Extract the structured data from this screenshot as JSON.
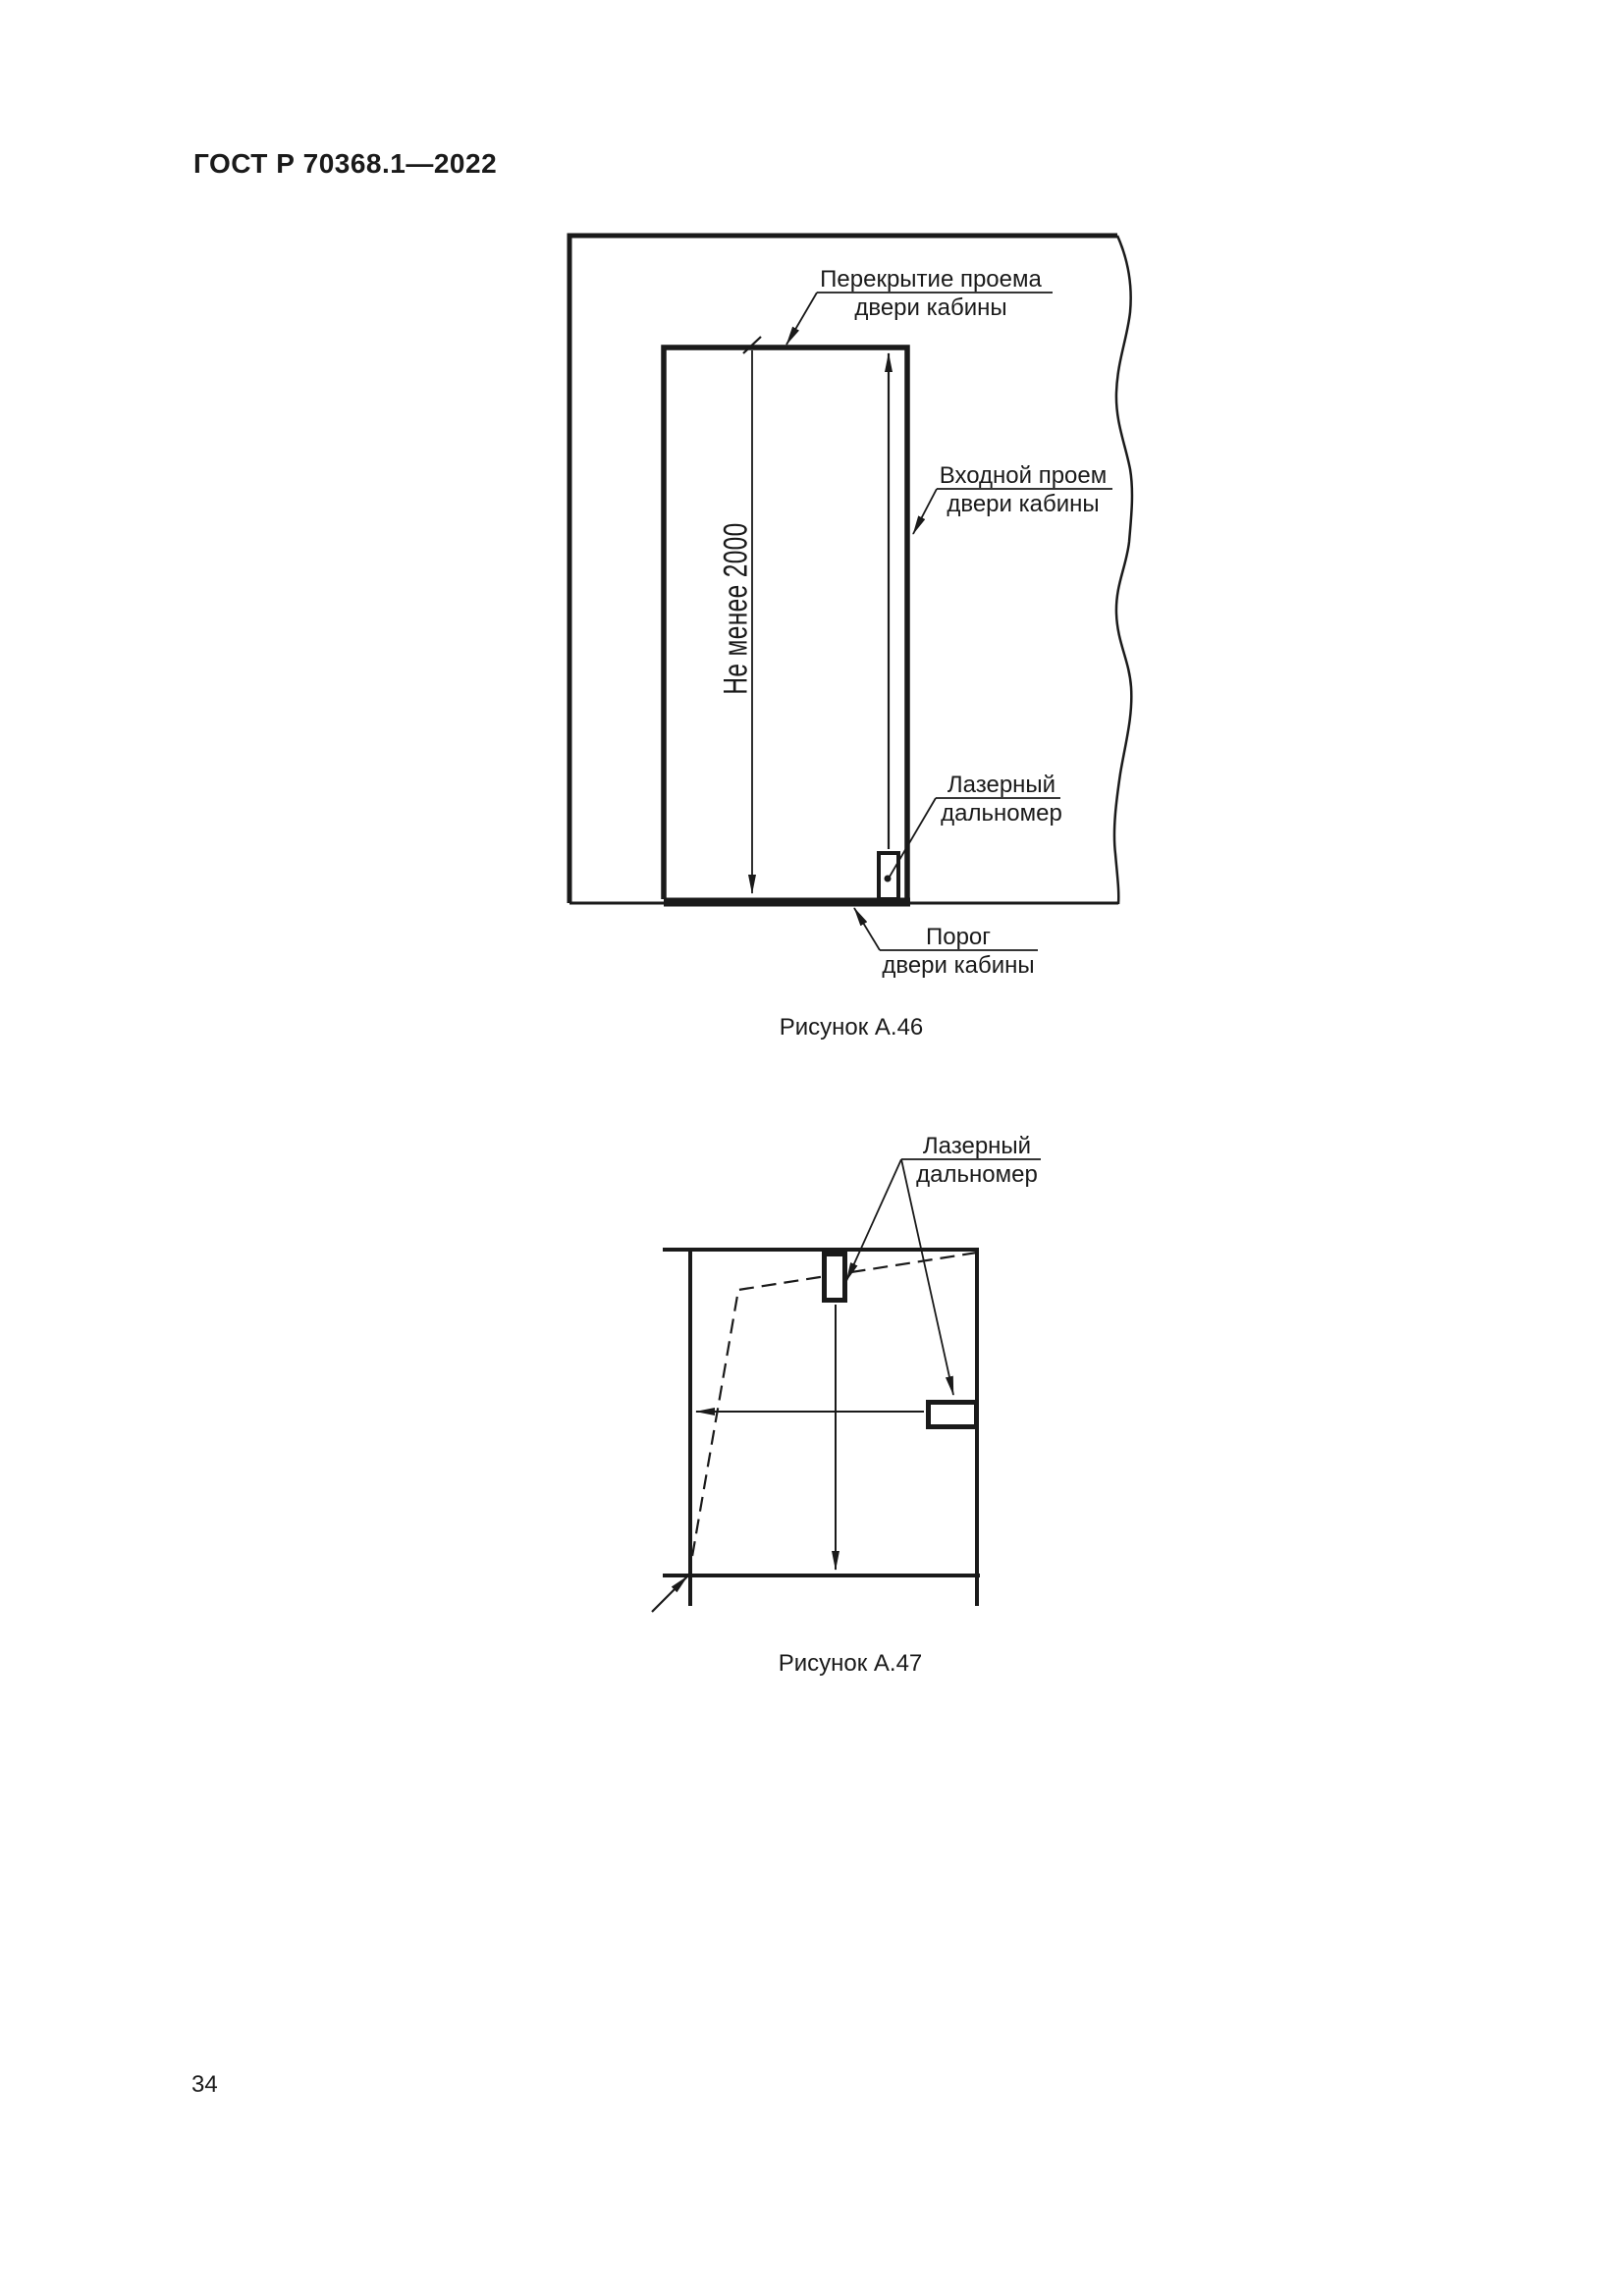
{
  "document": {
    "header": "ГОСТ Р 70368.1—2022",
    "page_number": "34"
  },
  "figure_a46": {
    "caption": "Рисунок А.46",
    "label_lintel": {
      "line1": "Перекрытие проема",
      "line2": "двери кабины"
    },
    "label_entrance": {
      "line1": "Входной проем",
      "line2": "двери кабины"
    },
    "label_laser": {
      "line1": "Лазерный",
      "line2": "дальномер"
    },
    "label_threshold": {
      "line1": "Порог",
      "line2": "двери кабины"
    },
    "dimension_text": "Не менее 2000"
  },
  "figure_a47": {
    "caption": "Рисунок А.47",
    "label_laser": {
      "line1": "Лазерный",
      "line2": "дальномер"
    }
  },
  "colors": {
    "ink": "#1a1a1a",
    "paper": "#ffffff"
  }
}
